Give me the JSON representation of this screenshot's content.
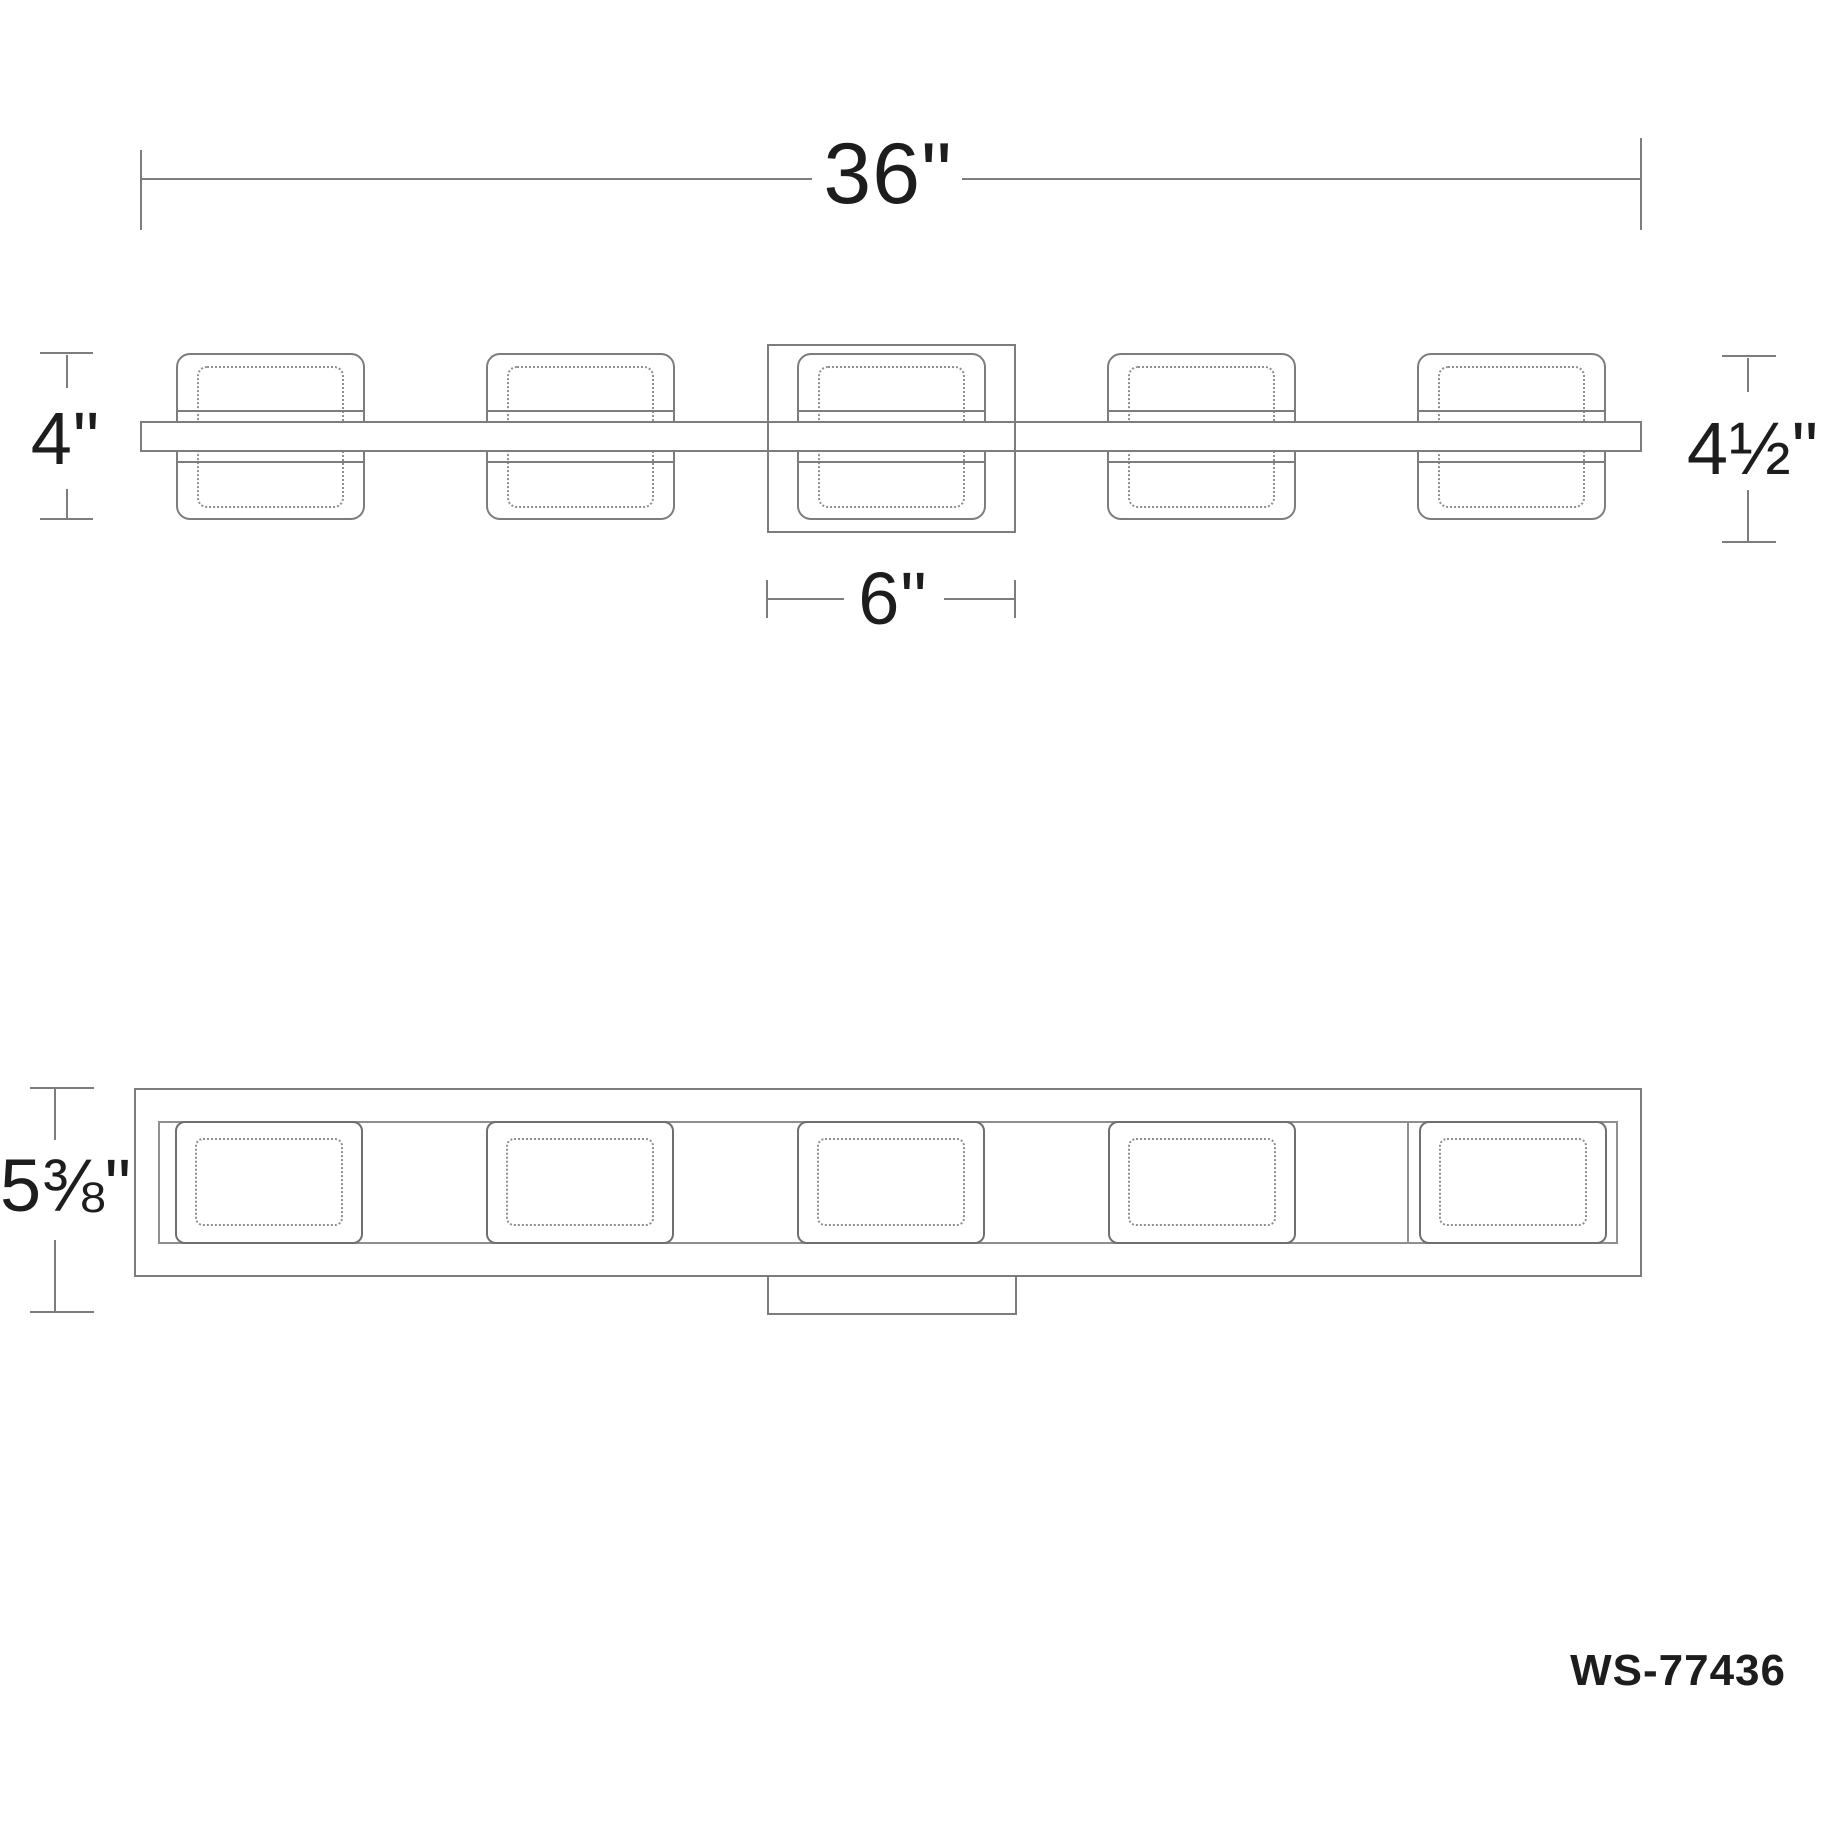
{
  "drawing": {
    "product_code": "WS-77436",
    "views": {
      "top": {
        "name": "top-plan-view",
        "num_lights": 5,
        "dim_overall_width": "36\"",
        "dim_shade_depth": "4\"",
        "dim_extension": "4½\"",
        "dim_canopy_width": "6\""
      },
      "front": {
        "name": "front-elevation-view",
        "num_lights": 5,
        "dim_overall_height": "5⅜\""
      }
    },
    "colors": {
      "background": "#ffffff",
      "line": "#7d7d7d",
      "module_line": "#6f6f6f",
      "dashed_line": "#8f8f8f",
      "text": "#1d1d1d"
    }
  }
}
